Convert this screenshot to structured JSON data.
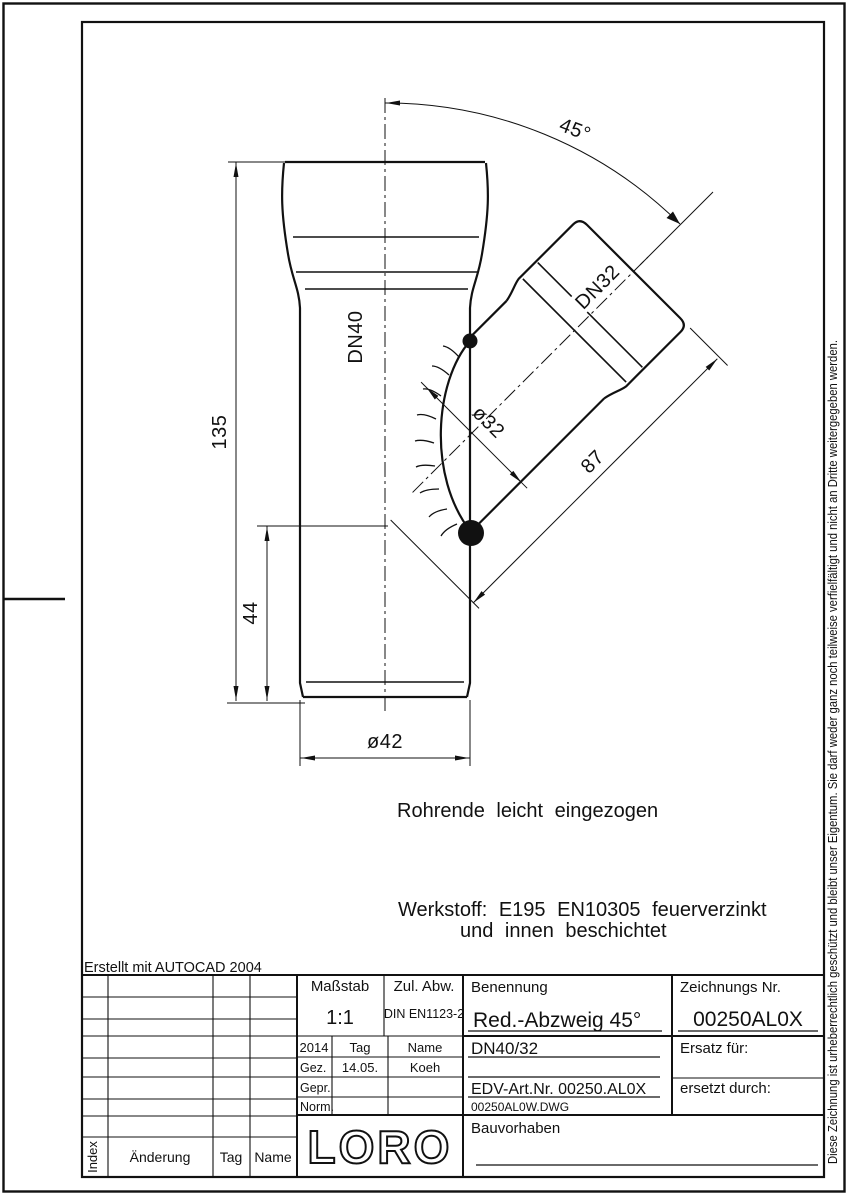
{
  "frame": {
    "created_with": "Erstellt mit AUTOCAD 2004",
    "copyright_vertical": "Diese Zeichnung ist urheberrechtlich geschützt und bleibt unser Eigentum. Sie darf weder ganz noch teilweise verfielfältigt und nicht an Dritte weitergegeben werden."
  },
  "drawing": {
    "dimensions": {
      "total_height": "135",
      "branch_height": "44",
      "main_outer_dia": "ø42",
      "branch_inner_dia": "ø32",
      "branch_length": "87",
      "branch_angle": "45°",
      "dn_main": "DN40",
      "dn_branch": "DN32"
    },
    "notes": {
      "pipe_end": "Rohrende leicht eingezogen",
      "material_line1": "Werkstoff: E195 EN10305 feuerverzinkt",
      "material_line2": "und innen beschichtet"
    }
  },
  "title_block": {
    "masstab_label": "Maßstab",
    "masstab_value": "1:1",
    "zul_abw_label": "Zul. Abw.",
    "zul_abw_value": "DIN EN1123-2",
    "year": "2014",
    "col_tag_label": "Tag",
    "col_name_label": "Name",
    "gez_label": "Gez.",
    "gez_tag": "14.05.",
    "gez_name": "Koeh",
    "gepr_label": "Gepr.",
    "norm_label": "Norm.",
    "benennung_label": "Benennung",
    "benennung_value": "Red.-Abzweig 45°",
    "size_value": "DN40/32",
    "edv_art_nr": "EDV-Art.Nr. 00250.AL0X",
    "dwg_file": "00250AL0W.DWG",
    "zeichnungs_nr_label": "Zeichnungs Nr.",
    "zeichnungs_nr_value": "00250AL0X",
    "ersatz_label": "Ersatz für:",
    "ersetzt_label": "ersetzt durch:",
    "bauvorhaben_label": "Bauvorhaben",
    "logo_text": "LORO",
    "revision": {
      "index_label": "Index",
      "aenderung_label": "Änderung",
      "tag_label": "Tag",
      "name_label": "Name"
    }
  }
}
